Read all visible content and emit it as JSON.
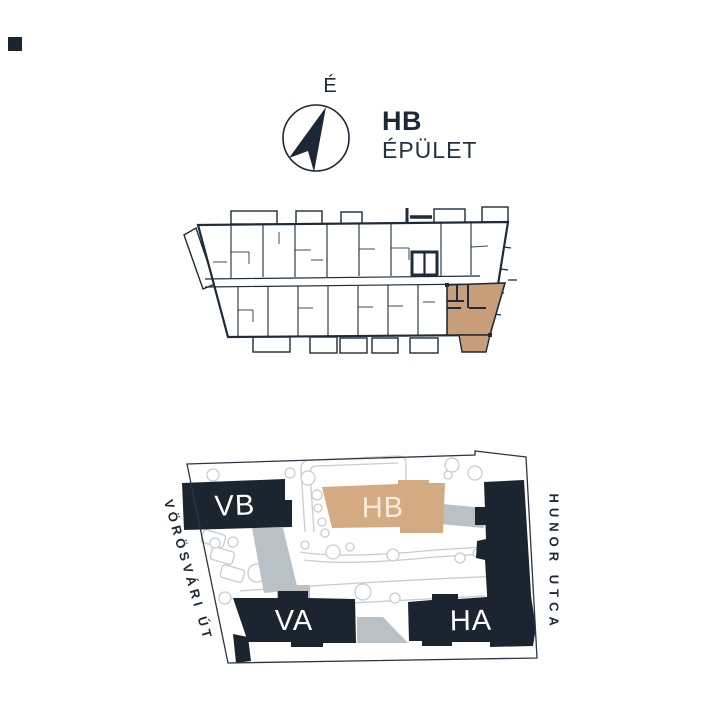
{
  "colors": {
    "navy": "#1c2836",
    "block_navy": "#1a2530",
    "unit_tan": "#c89d79",
    "block_tan": "#d3aa82",
    "gray_band": "#b9c0c6",
    "landscape_gray": "#c8ccd0",
    "cream": "#f7ecdc",
    "background": "#ffffff"
  },
  "compass": {
    "north_label": "É"
  },
  "header": {
    "building_code": "HB",
    "building_word": "ÉPÜLET"
  },
  "site_plan": {
    "blocks": [
      {
        "label": "VB"
      },
      {
        "label": "HB"
      },
      {
        "label": "VA"
      },
      {
        "label": "HA"
      }
    ],
    "streets": {
      "left": "VÖRÖSVÁRI ÚT",
      "right": "HUNOR UTCA"
    }
  }
}
